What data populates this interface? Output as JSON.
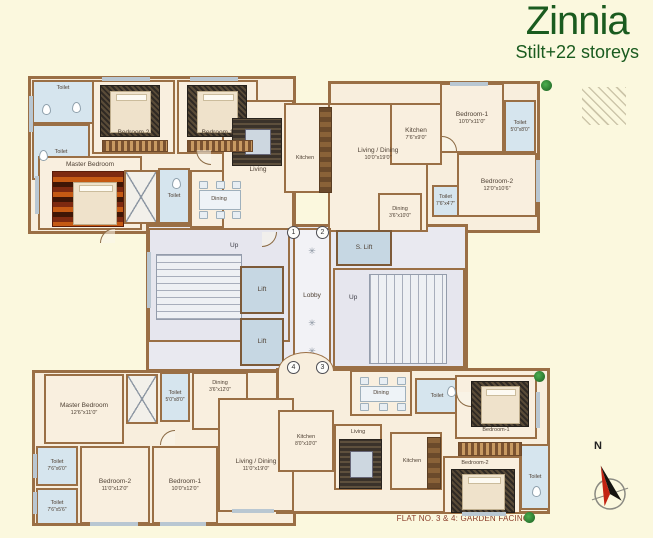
{
  "title": {
    "name": "Zinnia",
    "subtitle": "Stilt+22 storeys"
  },
  "flat_top_left": {
    "toilet_a": {
      "name": "Toilet"
    },
    "toilet_b": {
      "name": "Toilet"
    },
    "bedroom2": {
      "name": "Bedroom 2"
    },
    "bedroom1": {
      "name": "Bedroom 1"
    },
    "master_bedroom": {
      "name": "Master Bedroom"
    },
    "toilet_c": {
      "name": "Toilet"
    },
    "dining": {
      "name": "Dining"
    },
    "living": {
      "name": "Living"
    },
    "kitchen": {
      "name": "Kitchen"
    }
  },
  "flat_top_right": {
    "living_dining": {
      "name": "Living / Dining",
      "dim": "10'0\"x19'0\""
    },
    "kitchen": {
      "name": "Kitchen",
      "dim": "7'6\"x9'0\""
    },
    "dining": {
      "name": "Dining",
      "dim": "3'6\"x10'0\""
    },
    "bedroom1": {
      "name": "Bedroom-1",
      "dim": "10'0\"x11'0\""
    },
    "toilet_a": {
      "name": "Toilet",
      "dim": "5'0\"x8'0\""
    },
    "bedroom2": {
      "name": "Bedroom-2",
      "dim": "12'0\"x10'6\""
    },
    "toilet_b": {
      "name": "Toilet",
      "dim": "7'6\"x4'7\""
    }
  },
  "core": {
    "stair_left_up": "Up",
    "stair_right_up": "Up",
    "lift_a": "Lift",
    "lift_b": "Lift",
    "service_lift": "S. Lift",
    "lobby": "Lobby",
    "flat_markers": {
      "f1": "1",
      "f2": "2",
      "f3": "3",
      "f4": "4"
    }
  },
  "flat_bottom_left": {
    "master_bedroom": {
      "name": "Master Bedroom",
      "dim": "12'6\"x11'0\""
    },
    "toilet_top": {
      "name": "Toilet",
      "dim": "5'0\"x8'0\""
    },
    "dining": {
      "name": "Dining",
      "dim": "3'6\"x12'0\""
    },
    "toilet_mid": {
      "name": "Toilet",
      "dim": "7'6\"x6'0\""
    },
    "toilet_bot": {
      "name": "Toilet",
      "dim": "7'6\"x5'6\""
    },
    "bedroom2": {
      "name": "Bedroom-2",
      "dim": "11'0\"x12'0\""
    },
    "bedroom1": {
      "name": "Bedroom-1",
      "dim": "10'0\"x12'0\""
    },
    "living_dining": {
      "name": "Living / Dining",
      "dim": "11'0\"x19'0\""
    }
  },
  "flat_bottom_right": {
    "kitchen_a": {
      "name": "Kitchen",
      "dim": "8'0\"x10'0\""
    },
    "living": {
      "name": "Living"
    },
    "dining": {
      "name": "Dining"
    },
    "toilet_a": {
      "name": "Toilet"
    },
    "kitchen_b": {
      "name": "Kitchen"
    },
    "bedroom1": {
      "name": "Bedroom-1"
    },
    "bedroom2": {
      "name": "Bedroom-2"
    },
    "toilet_b": {
      "name": "Toilet"
    }
  },
  "footer": {
    "caption": "FLAT NO. 3 & 4: GARDEN FACING"
  },
  "compass": {
    "label": "N"
  },
  "colors": {
    "background": "#fbf8de",
    "title_green": "#1a5b1f",
    "wall_brown": "#9a6f45",
    "floor_cream": "#f8eedd",
    "wet_blue": "#d6e5ee",
    "lift_blue": "#c6d7e3",
    "core_grey": "#e9e9f0",
    "footer_maroon": "#8a3c28"
  }
}
